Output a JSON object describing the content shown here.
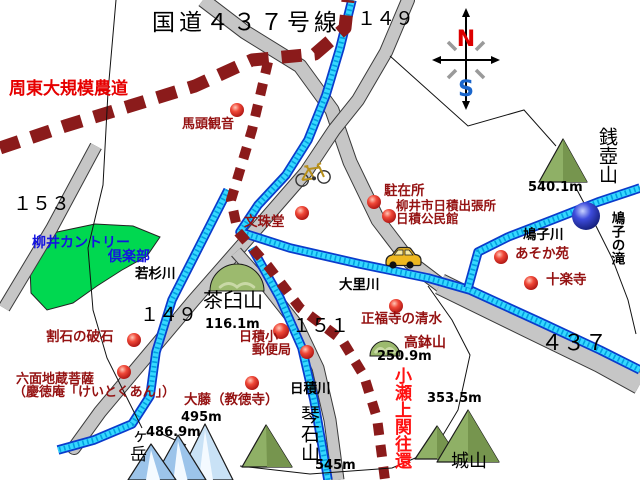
{
  "colors": {
    "black": "#000000",
    "maroon": "#951212",
    "red": "#e60000",
    "kose": "#ff1212",
    "blue": "#1414e0",
    "road_fill": "#c6c6c6",
    "road_edge": "#3a3a3a",
    "dash_road": "#8b1b1b",
    "river_outer": "#0a3ccc",
    "river_inner": "#36d8ff",
    "river_dots": "#00a0e0",
    "golf_green": "#00d850",
    "mtn_green": "#8fb066",
    "mtn_green_dark": "#76954e",
    "mtn_stroke": "#1a1a1a",
    "dome_green": "#9cba6e",
    "dome_light": "#c9d9a6",
    "mtn_blue": "#9cc4ea",
    "mtn_blue_light": "#c9e2f6",
    "mtn_white": "#f4faff",
    "compass_n": "#dd0000",
    "compass_s": "#1a66cc",
    "compass_tick": "#9a9a9a",
    "vehicle_yellow": "#efb820",
    "window_yellow": "#f7e9a0"
  },
  "compass": {
    "north": "N",
    "south": "S",
    "cx": 466,
    "cy": 60
  },
  "roads": [
    {
      "id": "road-route-437-north",
      "w": 13,
      "pts": [
        [
          203,
          0
        ],
        [
          245,
          32
        ],
        [
          300,
          66
        ],
        [
          332,
          110
        ],
        [
          350,
          162
        ],
        [
          378,
          220
        ],
        [
          410,
          262
        ],
        [
          447,
          290
        ]
      ]
    },
    {
      "id": "road-route-437-wide",
      "w": 20,
      "pts": [
        [
          440,
          284
        ],
        [
          530,
          328
        ],
        [
          600,
          362
        ],
        [
          640,
          384
        ]
      ]
    },
    {
      "id": "road-route-149",
      "w": 12,
      "cap": "round",
      "pts": [
        [
          408,
          0
        ],
        [
          386,
          52
        ],
        [
          358,
          100
        ],
        [
          334,
          130
        ],
        [
          306,
          172
        ],
        [
          266,
          218
        ],
        [
          236,
          252
        ],
        [
          194,
          300
        ],
        [
          152,
          350
        ],
        [
          100,
          412
        ],
        [
          74,
          448
        ]
      ]
    },
    {
      "id": "road-route-151",
      "w": 11,
      "pts": [
        [
          236,
          252
        ],
        [
          268,
          288
        ],
        [
          298,
          326
        ],
        [
          318,
          368
        ],
        [
          330,
          420
        ],
        [
          338,
          480
        ]
      ]
    },
    {
      "id": "road-route-153",
      "w": 11,
      "pts": [
        [
          96,
          146
        ],
        [
          52,
          228
        ],
        [
          4,
          308
        ]
      ]
    }
  ],
  "dashed_roads": [
    {
      "id": "dashed-road-shuto-farm",
      "w": 13,
      "dash": "20 13",
      "pts": [
        [
          0,
          148
        ],
        [
          65,
          126
        ],
        [
          130,
          106
        ],
        [
          195,
          86
        ],
        [
          252,
          60
        ],
        [
          315,
          54
        ],
        [
          345,
          28
        ],
        [
          348,
          0
        ]
      ]
    },
    {
      "id": "dashed-road-kose-kaido",
      "w": 10,
      "dash": "12 10",
      "pts": [
        [
          268,
          62
        ],
        [
          252,
          130
        ],
        [
          231,
          200
        ],
        [
          238,
          232
        ],
        [
          268,
          266
        ],
        [
          300,
          308
        ],
        [
          342,
          340
        ],
        [
          364,
          376
        ],
        [
          377,
          418
        ],
        [
          385,
          480
        ]
      ]
    }
  ],
  "rivers": [
    {
      "id": "river-main-osato",
      "pts": [
        [
          352,
          0
        ],
        [
          340,
          48
        ],
        [
          326,
          95
        ],
        [
          308,
          140
        ],
        [
          286,
          175
        ],
        [
          258,
          205
        ],
        [
          240,
          232
        ],
        [
          290,
          248
        ],
        [
          360,
          264
        ],
        [
          428,
          278
        ],
        [
          470,
          290
        ],
        [
          540,
          322
        ],
        [
          600,
          350
        ],
        [
          640,
          370
        ]
      ]
    },
    {
      "id": "river-hatoko",
      "pts": [
        [
          640,
          188
        ],
        [
          598,
          202
        ],
        [
          552,
          220
        ],
        [
          508,
          237
        ],
        [
          478,
          252
        ],
        [
          468,
          288
        ]
      ]
    },
    {
      "id": "river-wakasugi",
      "pts": [
        [
          228,
          190
        ],
        [
          200,
          245
        ],
        [
          172,
          300
        ],
        [
          156,
          352
        ],
        [
          150,
          396
        ],
        [
          132,
          424
        ],
        [
          94,
          440
        ],
        [
          58,
          450
        ]
      ]
    },
    {
      "id": "river-hizumi",
      "pts": [
        [
          252,
          248
        ],
        [
          280,
          298
        ],
        [
          302,
          348
        ],
        [
          314,
          400
        ],
        [
          322,
          445
        ],
        [
          328,
          480
        ]
      ]
    }
  ],
  "boundaries": [
    {
      "id": "boundary-zenitsubo-north",
      "pts": [
        [
          390,
          56
        ],
        [
          468,
          126
        ],
        [
          524,
          110
        ],
        [
          556,
          146
        ]
      ]
    },
    {
      "id": "boundary-zenitsubo-falls",
      "pts": [
        [
          576,
          188
        ],
        [
          592,
          218
        ],
        [
          612,
          258
        ],
        [
          628,
          300
        ],
        [
          636,
          334
        ]
      ]
    },
    {
      "id": "boundary-shiroyama",
      "pts": [
        [
          428,
          286
        ],
        [
          452,
          320
        ],
        [
          470,
          355
        ],
        [
          458,
          410
        ],
        [
          434,
          450
        ],
        [
          392,
          468
        ],
        [
          310,
          474
        ],
        [
          240,
          466
        ]
      ]
    },
    {
      "id": "boundary-west",
      "pts": [
        [
          116,
          0
        ],
        [
          108,
          92
        ],
        [
          103,
          185
        ],
        [
          88,
          248
        ],
        [
          93,
          310
        ],
        [
          107,
          358
        ],
        [
          128,
          400
        ],
        [
          142,
          428
        ]
      ]
    },
    {
      "id": "boundary-gatake-leader",
      "pts": [
        [
          162,
          434
        ],
        [
          186,
          445
        ]
      ]
    }
  ],
  "areas": [
    {
      "id": "golf-course-area",
      "fill": "golf_green",
      "pts": [
        [
          57,
          232
        ],
        [
          95,
          224
        ],
        [
          133,
          226
        ],
        [
          160,
          237
        ],
        [
          147,
          256
        ],
        [
          122,
          270
        ],
        [
          97,
          286
        ],
        [
          73,
          303
        ],
        [
          47,
          310
        ],
        [
          31,
          293
        ],
        [
          30,
          266
        ],
        [
          40,
          246
        ]
      ]
    }
  ],
  "hills": [
    {
      "id": "chausuyama-hill",
      "cx": 237,
      "baseY": 291,
      "r": 27
    },
    {
      "id": "takahachiyama-hill",
      "cx": 385,
      "baseY": 356,
      "r": 15
    }
  ],
  "mountains": [
    {
      "id": "odake-peak-right",
      "type": "blue2",
      "peak": [
        205,
        424
      ],
      "bl": [
        177,
        480
      ],
      "br": [
        233,
        480
      ]
    },
    {
      "id": "odake-peak-mid",
      "type": "blue",
      "peak": [
        178,
        435
      ],
      "bl": [
        153,
        480
      ],
      "br": [
        206,
        480
      ]
    },
    {
      "id": "odake-peak-left",
      "type": "blue",
      "peak": [
        151,
        444
      ],
      "bl": [
        128,
        480
      ],
      "br": [
        176,
        480
      ]
    },
    {
      "id": "zenitsuboyama-peak",
      "type": "green",
      "peak": [
        563,
        139
      ],
      "bl": [
        539,
        182
      ],
      "br": [
        587,
        182
      ]
    },
    {
      "id": "kotoishiyama-peak",
      "type": "green",
      "peak": [
        266,
        425
      ],
      "bl": [
        242,
        467
      ],
      "br": [
        292,
        467
      ]
    },
    {
      "id": "shiroyama-peak-small",
      "type": "green",
      "peak": [
        437,
        426
      ],
      "bl": [
        415,
        459
      ],
      "br": [
        459,
        459
      ]
    },
    {
      "id": "shiroyama-peak-large",
      "type": "green",
      "peak": [
        468,
        410
      ],
      "bl": [
        437,
        462
      ],
      "br": [
        499,
        462
      ]
    }
  ],
  "spots": [
    {
      "id": "spot-batokannon",
      "x": 237,
      "y": 110,
      "r": 7
    },
    {
      "id": "spot-monjudo",
      "x": 302,
      "y": 213,
      "r": 7
    },
    {
      "id": "spot-chuzaisho",
      "x": 374,
      "y": 202,
      "r": 7
    },
    {
      "id": "spot-yanai-branch",
      "x": 389,
      "y": 216,
      "r": 7
    },
    {
      "id": "spot-asoka-en",
      "x": 501,
      "y": 257,
      "r": 7
    },
    {
      "id": "spot-jurakuji",
      "x": 531,
      "y": 283,
      "r": 7
    },
    {
      "id": "spot-wariishi",
      "x": 134,
      "y": 340,
      "r": 7
    },
    {
      "id": "spot-rokumen-jizo",
      "x": 124,
      "y": 372,
      "r": 7
    },
    {
      "id": "spot-shofukuji",
      "x": 396,
      "y": 306,
      "r": 7
    },
    {
      "id": "spot-hizumi-elem",
      "x": 281,
      "y": 331,
      "r": 8
    },
    {
      "id": "spot-post-office",
      "x": 307,
      "y": 352,
      "r": 7
    },
    {
      "id": "spot-ofuji",
      "x": 252,
      "y": 383,
      "r": 7
    }
  ],
  "falls_marker": {
    "id": "spot-hatoko-falls",
    "x": 586,
    "y": 216,
    "r": 14
  },
  "vehicles": {
    "car": {
      "x": 384,
      "y": 246
    },
    "bicycle": {
      "x": 294,
      "y": 165
    }
  },
  "labels": [
    {
      "id": "map-title",
      "t": "国道４３７号線",
      "x": 152,
      "y": 12,
      "s": 23,
      "c": "black",
      "ls": 4
    },
    {
      "id": "route-149-top",
      "t": "１４９",
      "x": 357,
      "y": 10,
      "s": 19,
      "c": "black"
    },
    {
      "id": "route-153",
      "t": "１５３",
      "x": 13,
      "y": 195,
      "s": 19,
      "c": "black"
    },
    {
      "id": "route-149-mid",
      "t": "１４９",
      "x": 140,
      "y": 306,
      "s": 19,
      "c": "black"
    },
    {
      "id": "route-151",
      "t": "１５１",
      "x": 292,
      "y": 317,
      "s": 19,
      "c": "black"
    },
    {
      "id": "route-437",
      "t": "４３７",
      "x": 541,
      "y": 333,
      "s": 22,
      "c": "black"
    },
    {
      "id": "shuto-farm-road",
      "t": "周東大規模農道",
      "x": 9,
      "y": 81,
      "s": 17,
      "c": "red",
      "b": 1
    },
    {
      "id": "kose-kaido",
      "t": "小瀬上関往還",
      "x": 392,
      "y": 367,
      "s": 17,
      "c": "kose",
      "b": 1,
      "v": 1
    },
    {
      "id": "batokannon",
      "t": "馬頭観音",
      "x": 182,
      "y": 118,
      "s": 13,
      "c": "maroon",
      "b": 1
    },
    {
      "id": "monjudo",
      "t": "文珠堂",
      "x": 244,
      "y": 216,
      "s": 13.5,
      "c": "maroon",
      "b": 1
    },
    {
      "id": "chuzaisho",
      "t": "駐在所",
      "x": 384,
      "y": 185,
      "s": 13.5,
      "c": "maroon",
      "b": 1
    },
    {
      "id": "yanai-branch",
      "t": "柳井市日積出張所",
      "x": 396,
      "y": 200,
      "s": 12.5,
      "c": "maroon",
      "b": 1
    },
    {
      "id": "kominkan",
      "t": "日積公民館",
      "x": 396,
      "y": 213,
      "s": 12.5,
      "c": "maroon",
      "b": 1
    },
    {
      "id": "asoka-en",
      "t": "あそか苑",
      "x": 515,
      "y": 248,
      "s": 13.5,
      "c": "maroon",
      "b": 1
    },
    {
      "id": "jurakuji",
      "t": "十楽寺",
      "x": 546,
      "y": 274,
      "s": 13.5,
      "c": "maroon",
      "b": 1
    },
    {
      "id": "shofukuji-spring",
      "t": "正福寺の清水",
      "x": 361,
      "y": 313,
      "s": 13.5,
      "c": "maroon",
      "b": 1
    },
    {
      "id": "wariishi",
      "t": "割石の破石",
      "x": 46,
      "y": 331,
      "s": 13.5,
      "c": "maroon",
      "b": 1
    },
    {
      "id": "rokumen-jizo",
      "t": "六面地蔵菩薩",
      "x": 16,
      "y": 373,
      "s": 13,
      "c": "maroon",
      "b": 1
    },
    {
      "id": "keitokuan",
      "t": "（慶徳庵「けいとくあん」）",
      "x": 13,
      "y": 386,
      "s": 13,
      "c": "maroon",
      "b": 1
    },
    {
      "id": "ofuji-kyotokuji",
      "t": "大藤（教徳寺）",
      "x": 184,
      "y": 394,
      "s": 13.5,
      "c": "maroon",
      "b": 1
    },
    {
      "id": "hizumi-elem",
      "t": "日積小",
      "x": 239,
      "y": 331,
      "s": 13,
      "c": "maroon",
      "b": 1
    },
    {
      "id": "post-office",
      "t": "郵便局",
      "x": 252,
      "y": 344,
      "s": 13,
      "c": "maroon",
      "b": 1
    },
    {
      "id": "takahachiyama",
      "t": "高鉢山",
      "x": 404,
      "y": 336,
      "s": 14,
      "c": "maroon",
      "b": 1
    },
    {
      "id": "takahachi-elev",
      "t": "250.9m",
      "x": 377,
      "y": 350,
      "s": 13,
      "c": "black",
      "b": 1
    },
    {
      "id": "chausuyama",
      "t": "茶臼山",
      "x": 203,
      "y": 290,
      "s": 20,
      "c": "black"
    },
    {
      "id": "chausu-elev",
      "t": "116.1m",
      "x": 205,
      "y": 318,
      "s": 13,
      "c": "black",
      "b": 1
    },
    {
      "id": "wakasugigawa",
      "t": "若杉川",
      "x": 135,
      "y": 268,
      "s": 13.5,
      "c": "black",
      "b": 1
    },
    {
      "id": "osatogawa",
      "t": "大里川",
      "x": 339,
      "y": 279,
      "s": 13.5,
      "c": "black",
      "b": 1
    },
    {
      "id": "hizumigawa",
      "t": "日積川",
      "x": 290,
      "y": 383,
      "s": 13.5,
      "c": "black",
      "b": 1
    },
    {
      "id": "hatokogawa",
      "t": "鳩子川",
      "x": 523,
      "y": 229,
      "s": 13.5,
      "c": "black",
      "b": 1
    },
    {
      "id": "hatoko-falls",
      "t": "鳩子の滝",
      "x": 609,
      "y": 211,
      "s": 13.5,
      "c": "black",
      "b": 1,
      "v": 1
    },
    {
      "id": "zenitsuboyama",
      "t": "銭壺山",
      "x": 597,
      "y": 127,
      "s": 19,
      "c": "black",
      "v": 1
    },
    {
      "id": "zenitsubo-elev",
      "t": "540.1m",
      "x": 528,
      "y": 181,
      "s": 13,
      "c": "black",
      "b": 1
    },
    {
      "id": "kotoishiyama",
      "t": "琴石山",
      "x": 299,
      "y": 405,
      "s": 19,
      "c": "black",
      "v": 1
    },
    {
      "id": "kotoishi-elev",
      "t": "545m",
      "x": 315,
      "y": 459,
      "s": 13,
      "c": "black",
      "b": 1
    },
    {
      "id": "shiroyama",
      "t": "城山",
      "x": 451,
      "y": 453,
      "s": 18,
      "c": "black"
    },
    {
      "id": "shiroyama-elev",
      "t": "353.5m",
      "x": 427,
      "y": 392,
      "s": 13,
      "c": "black",
      "b": 1
    },
    {
      "id": "gatake",
      "t": "ヶ岳",
      "x": 127,
      "y": 428,
      "s": 17,
      "c": "black",
      "v": 1
    },
    {
      "id": "gatake-elev",
      "t": "486.9m",
      "x": 146,
      "y": 426,
      "s": 13,
      "c": "black",
      "b": 1
    },
    {
      "id": "odake-elev",
      "t": "495m",
      "x": 181,
      "y": 411,
      "s": 13,
      "c": "black",
      "b": 1
    },
    {
      "id": "golf-name-1",
      "t": "柳井カントリー",
      "x": 32,
      "y": 236,
      "s": 14,
      "c": "blue",
      "b": 1
    },
    {
      "id": "golf-name-2",
      "t": "倶楽部",
      "x": 108,
      "y": 250,
      "s": 14,
      "c": "blue",
      "b": 1
    }
  ]
}
